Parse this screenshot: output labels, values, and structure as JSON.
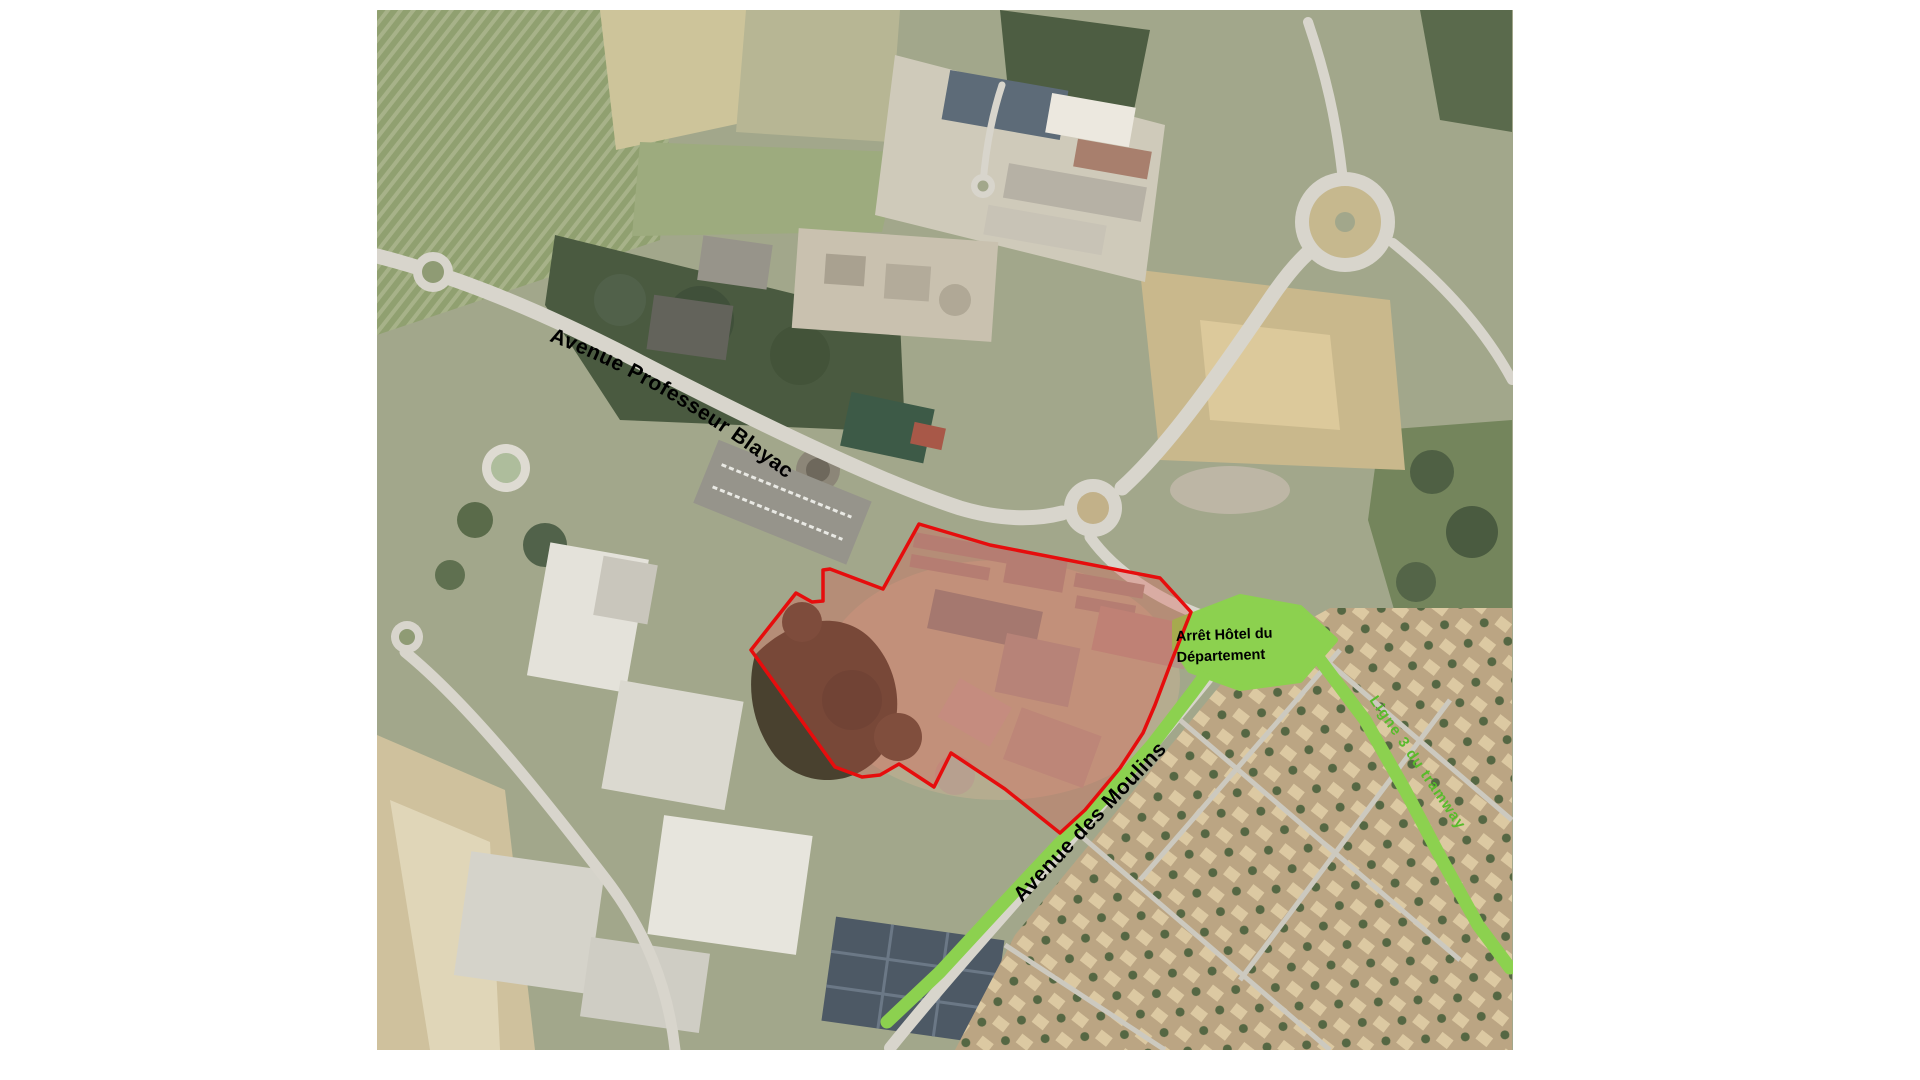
{
  "colors": {
    "page_background": "#ffffff",
    "site_outline": "#e60d0d",
    "site_fill": "rgba(222,88,78,0.32)",
    "tram_green": "#8cd14f",
    "tram_text_green": "#58bb2b",
    "street_label": "#000000"
  },
  "labels": {
    "avenue_blayac": "Avenue Professeur Blayac",
    "avenue_moulins": "Avenue des Moulins",
    "tram_stop_line1": "Arrêt Hôtel du",
    "tram_stop_line2": "Département",
    "tram_line": "Ligne 3 du tramway"
  },
  "overlays": {
    "site_outline_points": "919,524 990,545 1160,578 1191,612 1172,660 1155,705 1143,733 1120,768 1085,810 1060,833 1005,789 951,753 934,787 899,764 880,775 862,777 835,767 751,650 796,593 812,602 823,601 823,570 830,569 883,589",
    "tram_route_sw": "887,1022 940,972 1000,907 1060,843 1110,792 1152,745 1192,693 1220,655 1240,622",
    "tram_route_se": "1272,612 1320,660 1365,720 1405,790 1442,860 1478,925 1510,968",
    "tram_stop_area": "1175,622 1240,597 1300,608 1335,640 1300,680 1240,688 1190,670 1175,648",
    "tram_width": 13
  }
}
